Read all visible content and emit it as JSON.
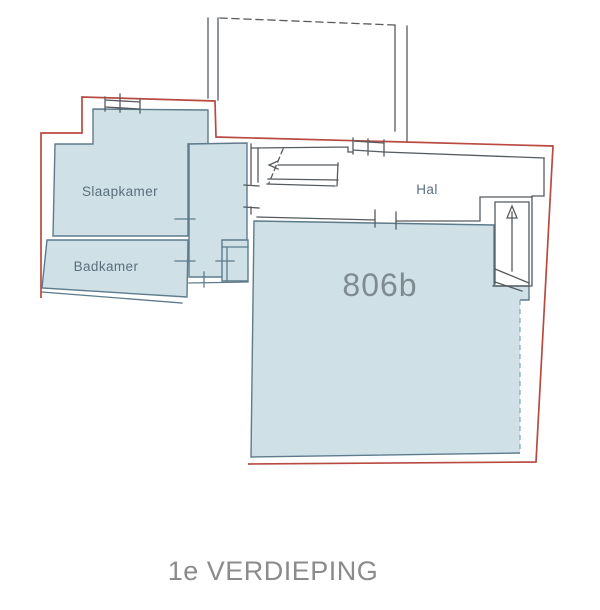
{
  "floorplan": {
    "floor_label": "1e VERDIEPING",
    "unit_label": "806b",
    "rooms": {
      "slaapkamer": {
        "label": "Slaapkamer"
      },
      "badkamer": {
        "label": "Badkamer"
      },
      "hal": {
        "label": "Hal"
      }
    },
    "colors": {
      "room_fill": "#cfe0e7",
      "room_stroke": "#5e7b8c",
      "plot_outline_red": "#b94a42",
      "wall_line": "#565b5f",
      "room_label_text": "#5b6e7c",
      "unit_label_text": "#7f8a91",
      "floor_label_text": "#8b8b8b"
    }
  }
}
